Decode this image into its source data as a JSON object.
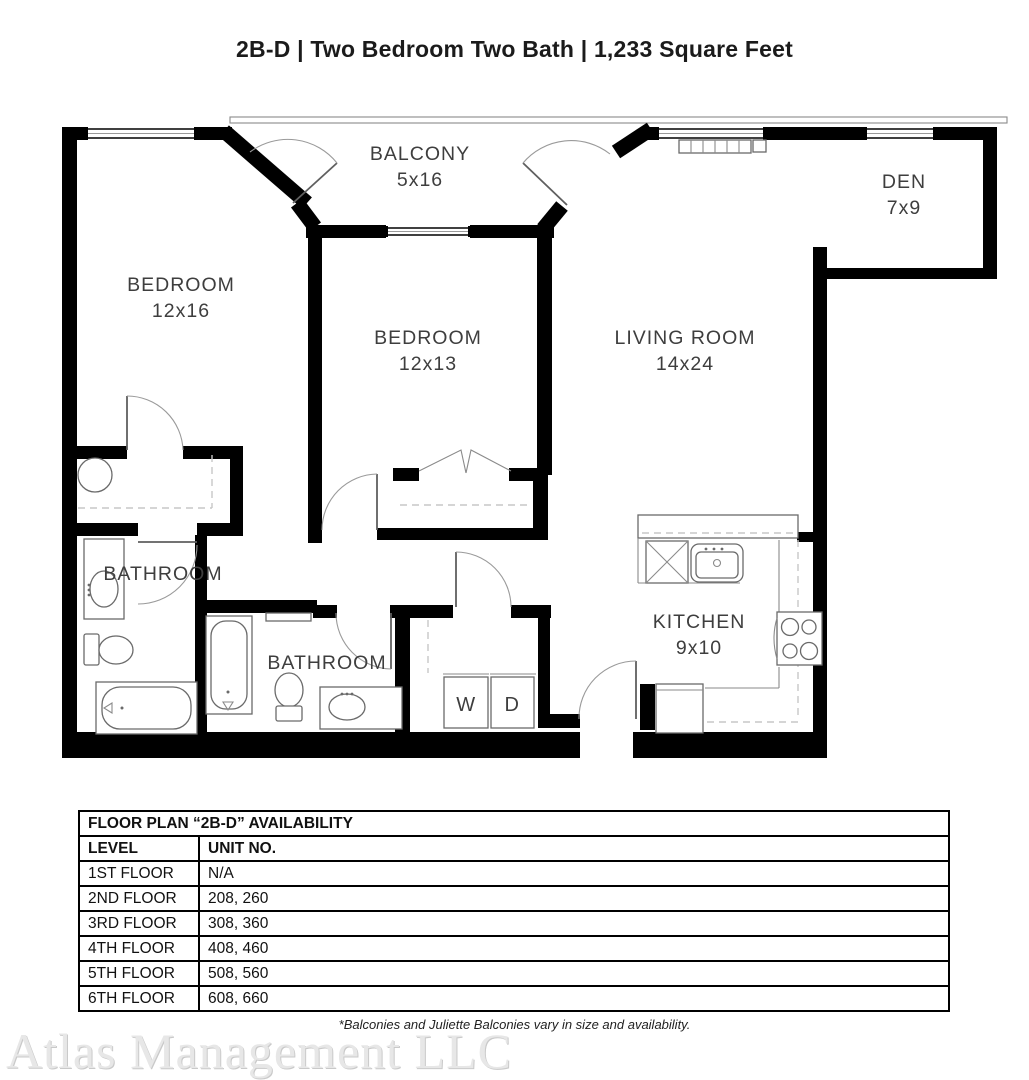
{
  "title": "2B-D | Two Bedroom Two Bath | 1,233 Square Feet",
  "floor_plan": {
    "rooms": [
      {
        "name": "BALCONY",
        "dims": "5x16"
      },
      {
        "name": "DEN",
        "dims": "7x9"
      },
      {
        "name": "BEDROOM",
        "dims": "12x16"
      },
      {
        "name": "BEDROOM",
        "dims": "12x13"
      },
      {
        "name": "LIVING ROOM",
        "dims": "14x24"
      },
      {
        "name": "BATHROOM"
      },
      {
        "name": "BATHROOM"
      },
      {
        "name": "KITCHEN",
        "dims": "9x10"
      }
    ],
    "labels": {
      "washer": "W",
      "dryer": "D"
    }
  },
  "availability_table": {
    "title": "FLOOR PLAN “2B-D” AVAILABILITY",
    "columns": [
      "LEVEL",
      "UNIT NO."
    ],
    "rows": [
      [
        "1ST FLOOR",
        "N/A"
      ],
      [
        "2ND FLOOR",
        "208, 260"
      ],
      [
        "3RD FLOOR",
        "308, 360"
      ],
      [
        "4TH FLOOR",
        "408, 460"
      ],
      [
        "5TH FLOOR",
        "508, 560"
      ],
      [
        "6TH FLOOR",
        "608, 660"
      ]
    ]
  },
  "footnote": "*Balconies and Juliette Balconies vary in size and availability.",
  "watermark": "Atlas Management LLC",
  "colors": {
    "walls": "#000000",
    "labels": "#3e3e3e",
    "fixtures": "#6a6a6a",
    "watermark": "#e7e7e7"
  }
}
